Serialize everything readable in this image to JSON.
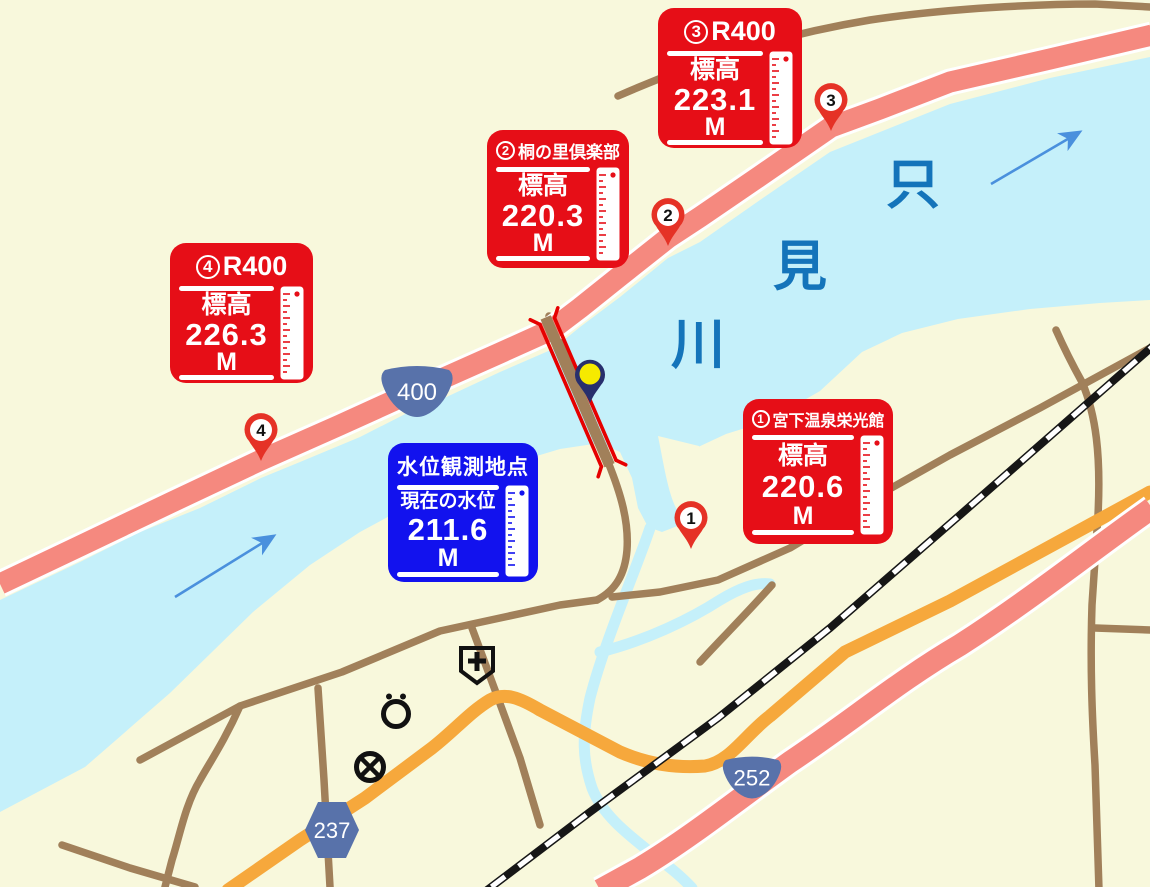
{
  "map_title": "Tadami river water level observation map",
  "colors": {
    "background": "#f8f8dc",
    "river": "#c5f0fa",
    "national_route_road": "#f5897f",
    "road_casing": "#ffffff",
    "main_road_orange": "#f6a83c",
    "local_road_brown": "#a1805a",
    "railway_black": "#161616",
    "label_box_red": "#e60e17",
    "label_box_blue": "#1212ee",
    "river_text_blue": "#1474ba",
    "route_shield_blue": "#5872aa",
    "flow_arrow_blue": "#4a90dd",
    "marker_pin_red": "#e53226",
    "observation_pin_navy": "#282f6d",
    "observation_pin_yellow": "#f6ea00",
    "bridge_symbol_red": "#e60000"
  },
  "elevation_labels": {
    "box1": {
      "badge": "1",
      "title": "宮下温泉栄光館",
      "field_label": "標高",
      "value": "220.6",
      "unit": "M"
    },
    "box2": {
      "badge": "2",
      "title": "桐の里倶楽部",
      "field_label": "標高",
      "value": "220.3",
      "unit": "M"
    },
    "box3": {
      "badge": "3",
      "title": "R400",
      "field_label": "標高",
      "value": "223.1",
      "unit": "M"
    },
    "box4": {
      "badge": "4",
      "title": "R400",
      "field_label": "標高",
      "value": "226.3",
      "unit": "M"
    }
  },
  "water_label": {
    "title": "水位観測地点",
    "field_label": "現在の水位",
    "value": "211.6",
    "unit": "M"
  },
  "river": {
    "name": "只見川",
    "chars": [
      "只",
      "見",
      "川"
    ]
  },
  "route_shields": {
    "national_400": "400",
    "national_252": "252",
    "prefectural_237": "237"
  },
  "markers": {
    "m1": "1",
    "m2": "2",
    "m3": "3",
    "m4": "4"
  },
  "map_symbols": [
    "hospital",
    "public-office",
    "police-station"
  ]
}
